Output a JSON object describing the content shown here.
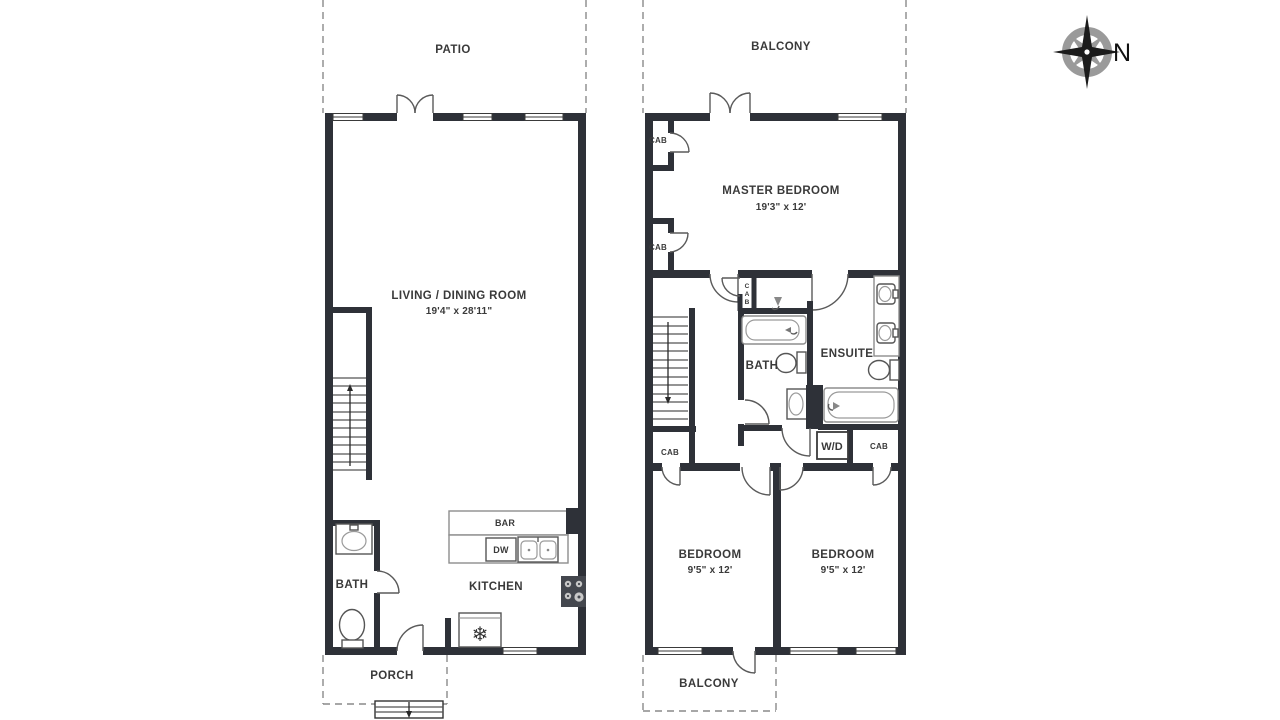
{
  "colors": {
    "wall": "#2e3138",
    "text": "#3a3a3a",
    "dash_line": "#8a8a8a",
    "compass_gray": "#9a9a9a"
  },
  "compass": {
    "north_label": "N"
  },
  "first_floor": {
    "patio_label": "PATIO",
    "living_dining_label": "LIVING / DINING ROOM",
    "living_dining_dims": "19'4\" x 28'11\"",
    "bath_label": "BATH",
    "kitchen_label": "KITCHEN",
    "bar_label": "BAR",
    "dishwasher_label": "DW",
    "fridge_icon": "snowflake-icon",
    "porch_label": "PORCH"
  },
  "second_floor": {
    "balcony_top_label": "BALCONY",
    "master_bedroom_label": "MASTER BEDROOM",
    "master_bedroom_dims": "19'3\" x 12'",
    "cabinet_label": "CAB",
    "bath_label": "BATH",
    "ensuite_label": "ENSUITE",
    "washer_dryer_label": "W/D",
    "bedroom_label": "BEDROOM",
    "bedroom_dims": "9'5\" x 12'",
    "balcony_bottom_label": "BALCONY"
  }
}
